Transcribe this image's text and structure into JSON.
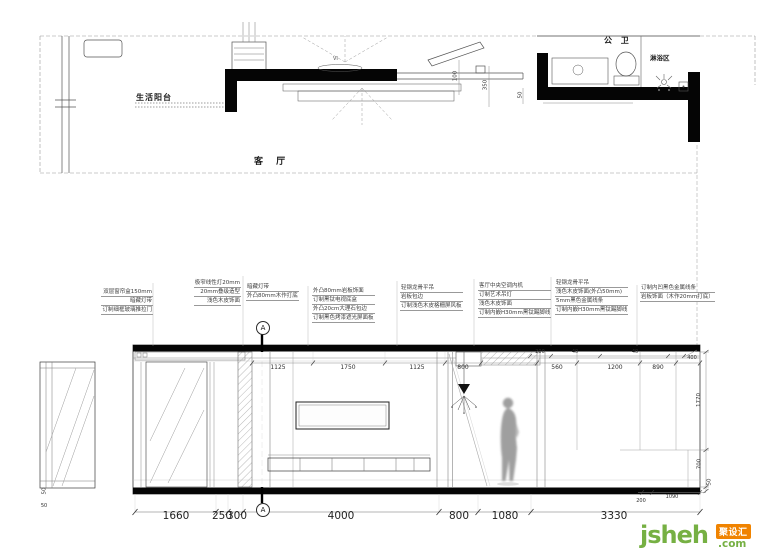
{
  "plan": {
    "labels": {
      "balcony": "生活阳台",
      "living_room": "客 厅",
      "bathroom": "公 卫",
      "shower": "淋浴区",
      "fixture_tag": "VI"
    },
    "dims": {
      "d100": "100",
      "d350": "350",
      "d50": "50"
    }
  },
  "elevation": {
    "notes": [
      {
        "lines": [
          "双层窗帘盒150mm",
          "暗藏灯带",
          "订制细框玻璃推拉门"
        ]
      },
      {
        "lines": [
          "极窄线性灯20mm",
          "20mm叠级造型",
          "浅色木皮饰面"
        ]
      },
      {
        "lines": [
          "暗藏灯带",
          "外凸80mm木作打底"
        ]
      },
      {
        "lines": [
          "外凸80mm岩板饰面",
          "订制黑钛电视底盒",
          "外凸20cm大理石包边",
          "订制黑色烤漆遮光屏面板"
        ]
      },
      {
        "lines": [
          "轻钢龙骨平吊",
          "岩板包边",
          "订制浅色木皮格栅屏风板"
        ]
      },
      {
        "lines": [
          "客厅中央空调内机",
          "订制艺术吊灯",
          "浅色木皮饰面",
          "订制内嵌H30mm黑钛踢脚线"
        ]
      },
      {
        "lines": [
          "轻钢龙骨平吊",
          "浅色木皮饰面(外凸50mm)",
          "5mm黑色金属线条",
          "订制内嵌H30mm黑钛踢脚线"
        ]
      },
      {
        "lines": [
          "订制内凹黑色金属线条",
          "岩板饰面（木作20mm打底）"
        ]
      }
    ],
    "section_marker": "A",
    "top_dims": [
      "1125",
      "1750",
      "1125",
      "800",
      "560",
      "1200",
      "890"
    ],
    "small_dims": [
      "200",
      "40",
      "40",
      "400"
    ],
    "right_dims": [
      "1770",
      "700",
      "50"
    ],
    "right_bottom_dims": [
      "200",
      "1090"
    ],
    "bottom_dims": [
      "1660",
      "250",
      "300",
      "4000",
      "800",
      "1080",
      "3330"
    ],
    "left_dims": [
      "50",
      "50"
    ]
  },
  "logo": {
    "brand": "jsheh",
    "suffix": ".com",
    "badge": "聚设汇",
    "green": "#76b043",
    "orange": "#f08300"
  }
}
